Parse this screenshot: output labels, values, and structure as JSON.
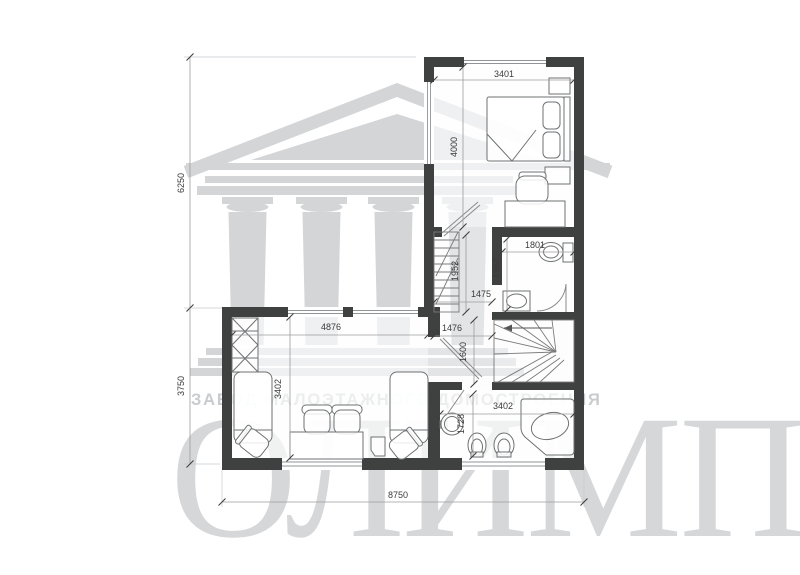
{
  "watermark": {
    "company_line": "ЗАВОД МАЛОЭТАЖНОГО ДОМОСТРОЕНИЯ",
    "brand": "ОЛИМП"
  },
  "dimensions": {
    "bedroom_width": "3401",
    "bedroom_depth": "4000",
    "upper_height": "6250",
    "lower_height": "3750",
    "total_width": "8750",
    "wc_width": "1801",
    "stair_depth": "1952",
    "wc_depth": "1952",
    "hall_width_upper": "1475",
    "hall_width_lower": "1476",
    "landing_depth": "1600",
    "room_width": "4876",
    "room_depth": "3402",
    "bath_width": "3402",
    "bath_depth": "1728"
  },
  "colors": {
    "wall": "#3f4040",
    "watermark": "#d3d5d7",
    "dimension_text": "#3a3a3a"
  }
}
